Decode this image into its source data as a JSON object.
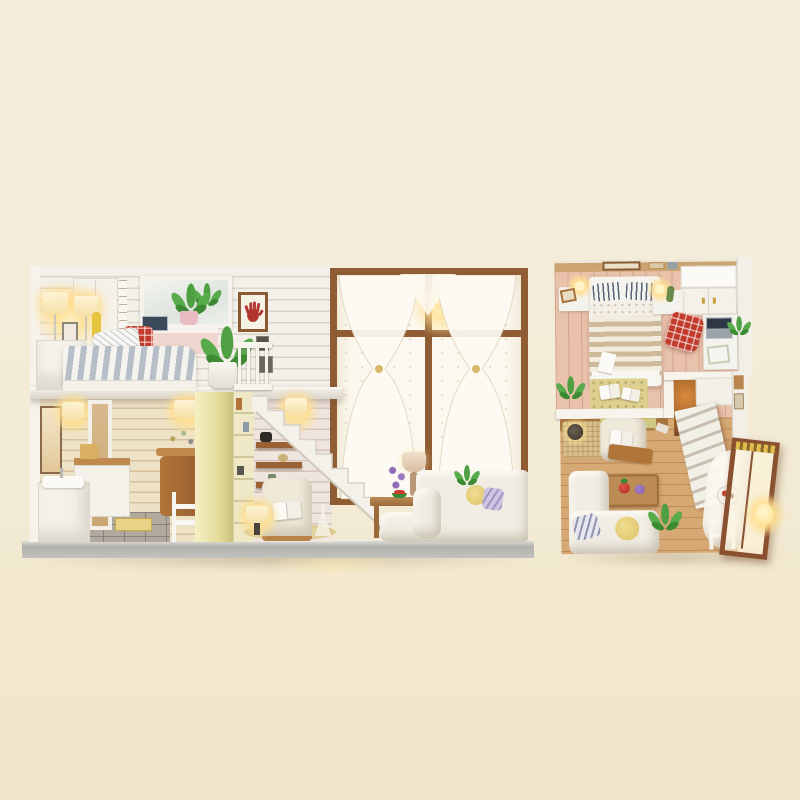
{
  "photo": {
    "subject": "DIY miniature wooden dollhouse kit - lit loft apartment interior",
    "views": {
      "front": "cutaway front elevation of two-story loft room with LED lighting",
      "top": "top-down floor-plan view of the same loft apartment"
    }
  },
  "palette": {
    "bg_top": "#f4eedf",
    "bg_bottom": "#f2e6ca",
    "base_gray": "#b3b1ac",
    "wall_white_plank": "#efebe3",
    "wall_warm_plank": "#eadcbd",
    "wall_pink_plank": "#e9dcd4",
    "pillar_yellow": "#e7e0a0",
    "window_frame_brown": "#8f5c33",
    "shelf_brown": "#9a6233",
    "floor_wood": "#dcbd92",
    "floor_pink_wood": "#e9c2ab",
    "floor_tile_gray": "#b1a99e",
    "lamp_glow": "#ffe79c",
    "plaid_red": "#c23a2b",
    "duvet_stripe_blue": "#b6bfc7",
    "leaf_green": "#4ea043",
    "sofa_cream": "#f1ede3",
    "lavender_purple": "#8e6bb5",
    "rug_yellow": "#ddd08e"
  },
  "front_view": {
    "upper_loft_bedroom": [
      "floor lamp lit",
      "table lamp lit",
      "photo frames",
      "white wardrobe",
      "growth-chart ruler",
      "wall window-mirror",
      "desk with laptop",
      "red plaid chair",
      "potted plant on sill",
      "handprint wall art",
      "small picture frames",
      "bed with blue striped duvet",
      "patterned pillow",
      "white nightstand",
      "large potted plant",
      "white loft railing"
    ],
    "lower_floor": [
      "framed mirror",
      "two lit wall lamps",
      "white wash-basin cabinet",
      "laundry counter with basket",
      "open white doorway",
      "grey tiled floor",
      "yellow door mat",
      "wooden side table with dried flowers",
      "white step stool",
      "pale yellow pillar",
      "bookshelf column",
      "white staircase",
      "under-stair wooden shelves",
      "cream armchair with open book",
      "glowing floor lamp",
      "round jute rug",
      "wire dress-form figurine"
    ],
    "living_room": [
      "large brown framed window",
      "sheer curtains tied with bows",
      "warm string lights",
      "wooden coffee table",
      "lavender bouquet",
      "beige table lamp",
      "watermelon slice",
      "white fabric sofa with chaise",
      "lilac striped pillow",
      "yellow pillow",
      "green plant"
    ],
    "base": "grey display base board with warm reflection"
  },
  "top_view": {
    "loft_bedroom": [
      "double bed with striped duvet",
      "two navy striped pillows",
      "dotted sheet",
      "two lit bedside lamps",
      "white nightstands",
      "leaning picture frames",
      "headboard wall frames",
      "white wardrobe",
      "white desk with laptop and magazine",
      "red plaid armchair",
      "patterned rug with two open books",
      "green plants"
    ],
    "ground_floor": [
      "white loft-edge railing",
      "under-loft cabinets",
      "reading-nook rug",
      "glowing ball lamp",
      "cream armchair with open book",
      "wooden serving board",
      "wooden coffee table with strawberry and purple flower",
      "L-shaped cream sofa",
      "striped pillow",
      "yellow pillow",
      "green plant",
      "top-down staircase with white landing",
      "stairwell warm glow",
      "open glazed door with brown frame",
      "warm door lantern",
      "white drapery",
      "plate of food",
      "white step ladder"
    ]
  }
}
